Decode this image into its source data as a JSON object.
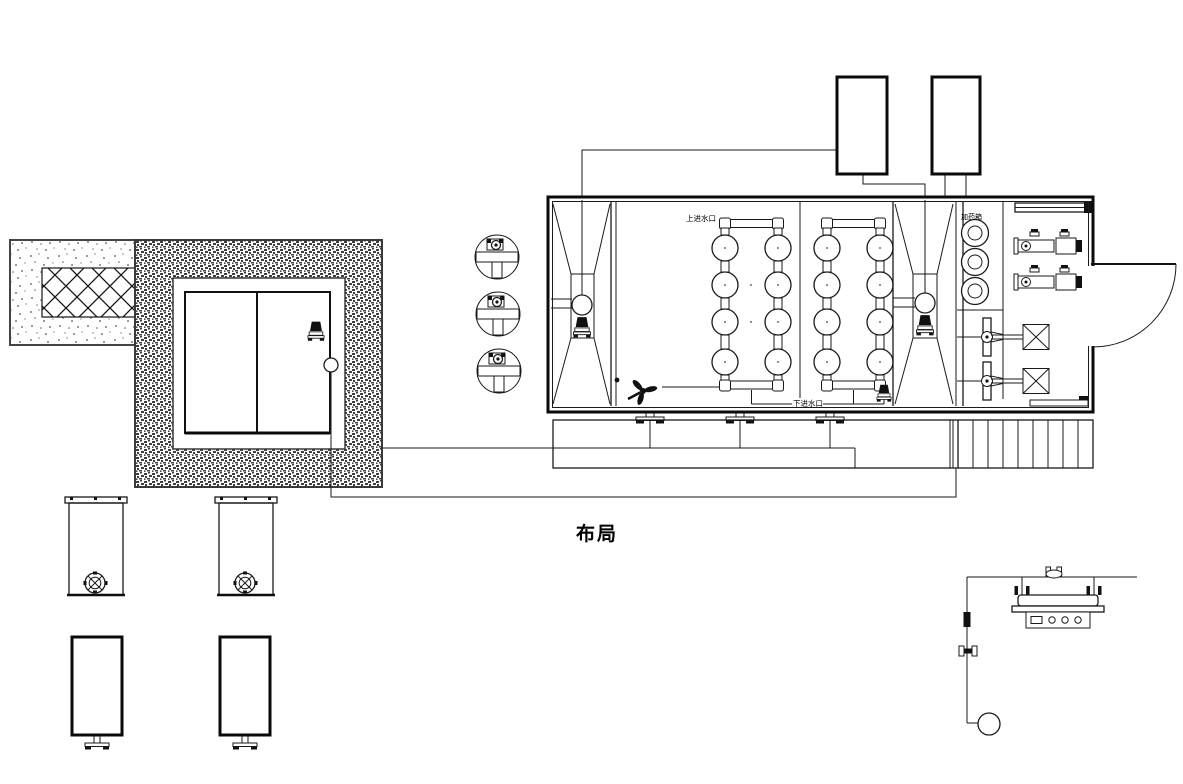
{
  "canvas": {
    "width": 1183,
    "height": 784,
    "background": "#ffffff",
    "ink": "#1a1a1a"
  },
  "title": {
    "text": "布局"
  },
  "labels": {
    "inlet_top": "上进水口",
    "inlet_bottom": "下进水口",
    "dosing": "加药箱"
  }
}
